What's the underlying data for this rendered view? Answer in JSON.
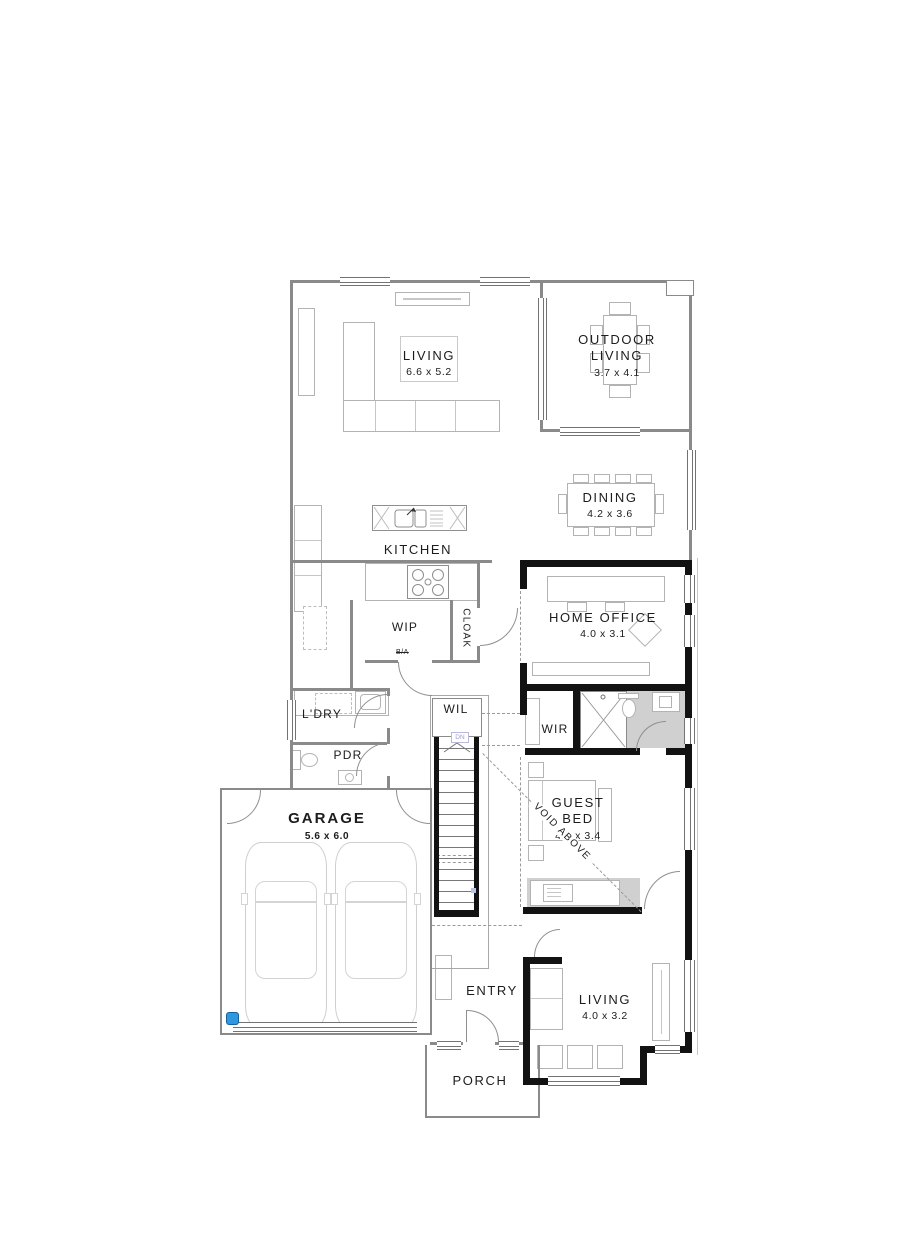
{
  "plan": {
    "rooms": {
      "living_main": {
        "label": "LIVING",
        "dims": "6.6 x 5.2"
      },
      "outdoor_living": {
        "label": "OUTDOOR LIVING",
        "dims": "3.7 x 4.1"
      },
      "dining": {
        "label": "DINING",
        "dims": "4.2 x 3.6"
      },
      "kitchen": {
        "label": "KITCHEN"
      },
      "wip": {
        "label": "WIP"
      },
      "cloak": {
        "label": "CLOAK"
      },
      "home_office": {
        "label": "HOME OFFICE",
        "dims": "4.0 x 3.1"
      },
      "ldry": {
        "label": "L'DRY"
      },
      "pdr": {
        "label": "PDR"
      },
      "wil": {
        "label": "WIL"
      },
      "wir": {
        "label": "WIR"
      },
      "guest_bed": {
        "label": "GUEST BED",
        "dims": "4.1 x 3.4"
      },
      "garage": {
        "label": "GARAGE",
        "dims": "5.6 x 6.0"
      },
      "entry": {
        "label": "ENTRY"
      },
      "living_guest": {
        "label": "LIVING",
        "dims": "4.0 x 3.2"
      },
      "porch": {
        "label": "PORCH"
      }
    },
    "annotations": {
      "void_above": "VOID ABOVE",
      "dn": "DN",
      "ba": "B/A"
    },
    "colors": {
      "wall_black": "#121212",
      "wall_thin": "#8a8a8a",
      "furniture_line": "#b3b3b3",
      "shaded_floor": "#d0d0d0",
      "accent_blue": "#2f96e0",
      "dn_label": "#9a9ad0"
    }
  }
}
